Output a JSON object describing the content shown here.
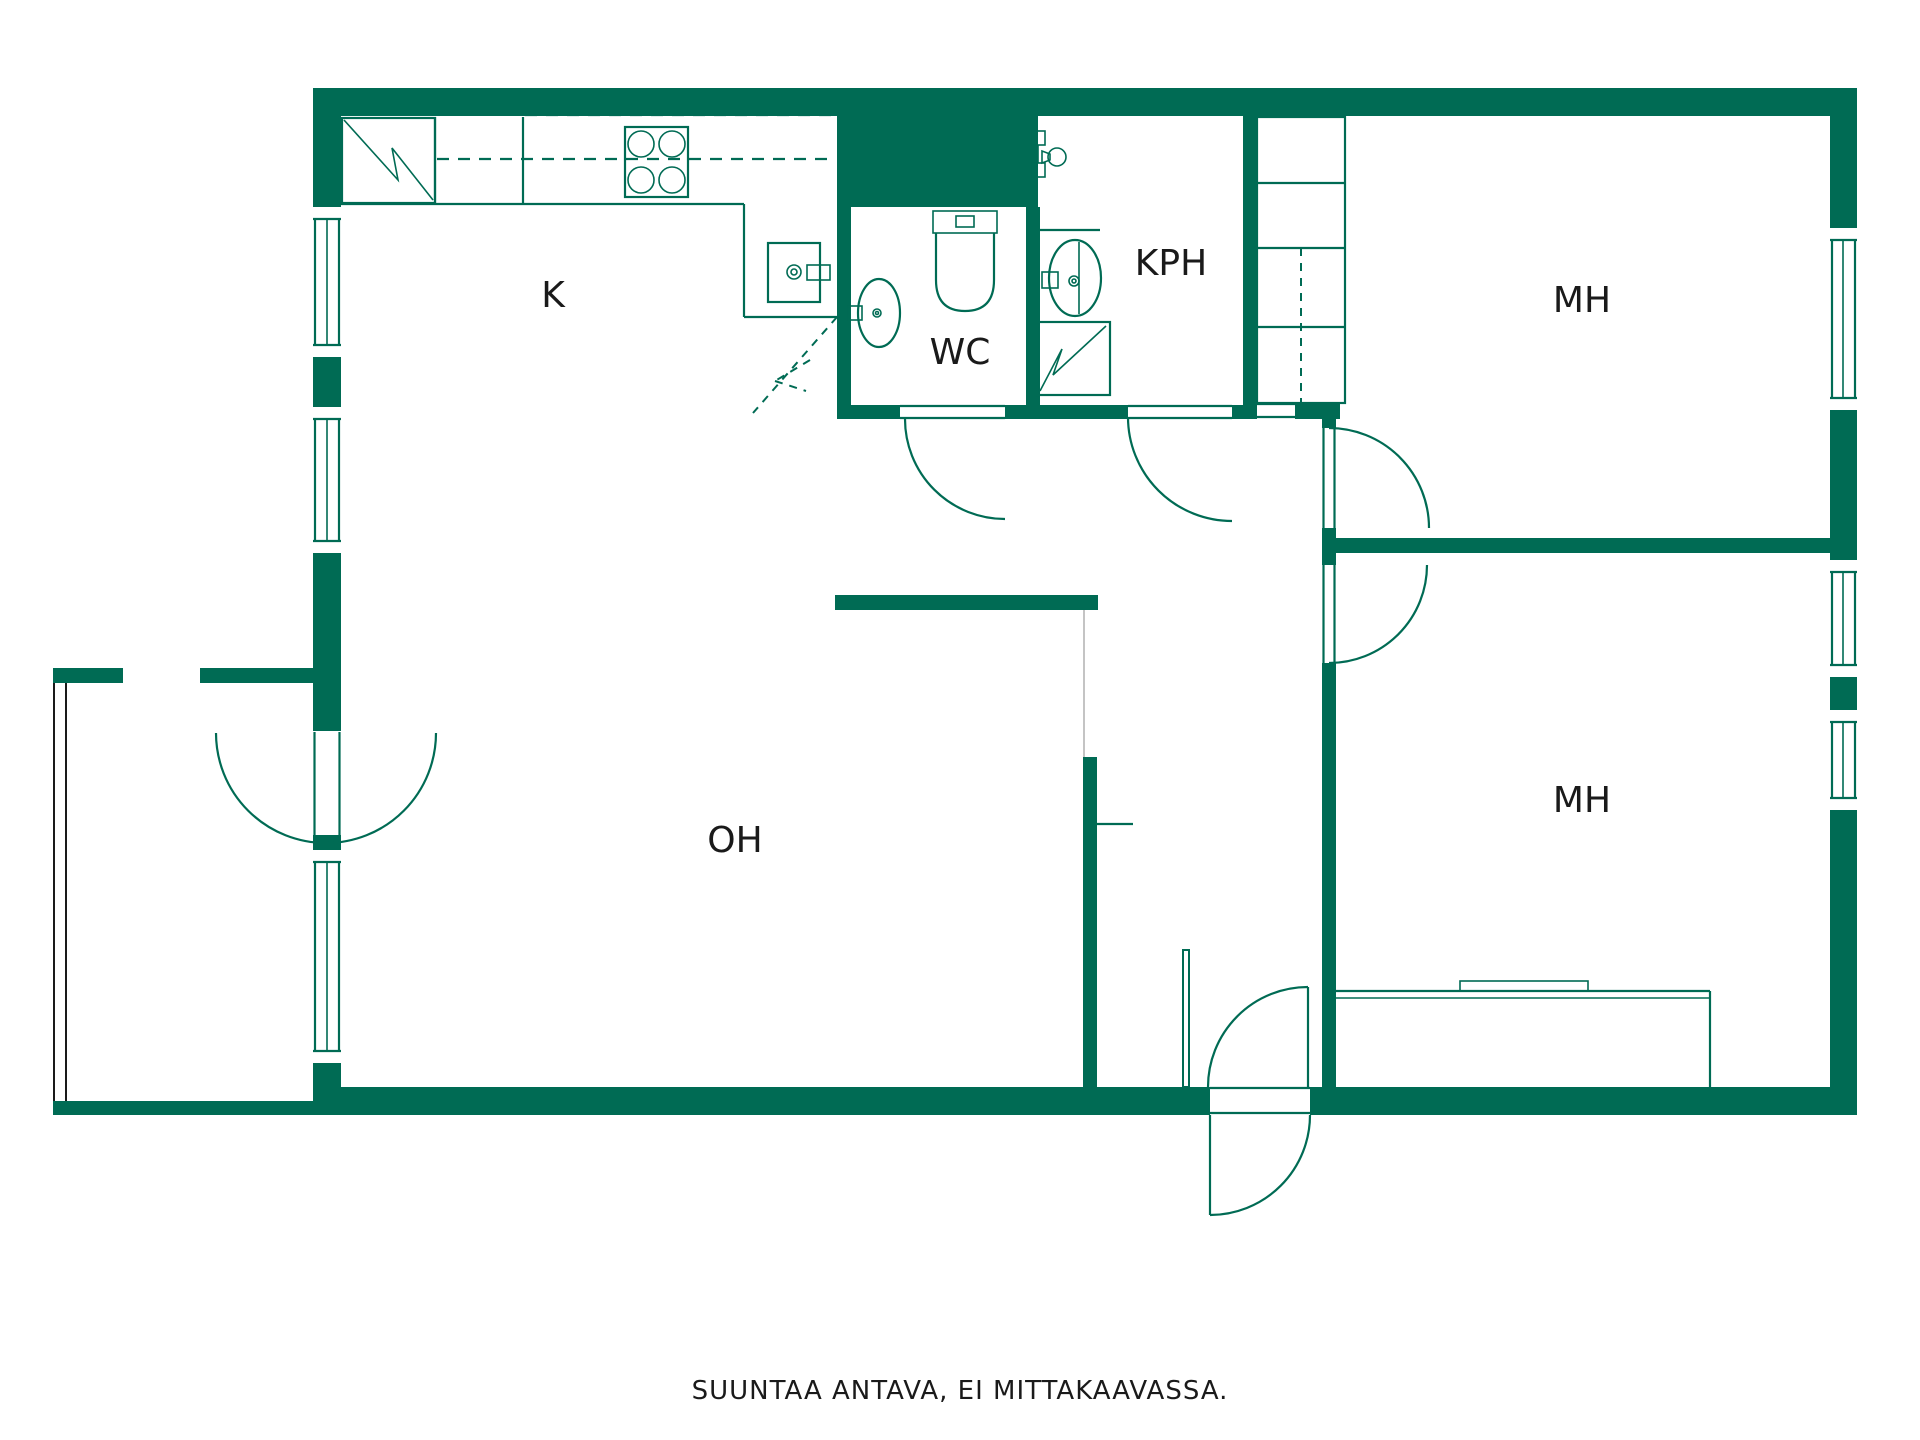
{
  "floorplan": {
    "rooms": [
      {
        "id": "kitchen",
        "label": "K"
      },
      {
        "id": "wc",
        "label": "WC"
      },
      {
        "id": "bathroom",
        "label": "KPH"
      },
      {
        "id": "bedroom-1",
        "label": "MH"
      },
      {
        "id": "bedroom-2",
        "label": "MH"
      },
      {
        "id": "living-room",
        "label": "OH"
      }
    ],
    "footnote": "SUUNTAA ANTAVA, EI MITTAKAAVASSA.",
    "colors": {
      "wall": "#006B54",
      "balcony_line": "#1a1a1a",
      "text": "#1a1a1a",
      "background": "#ffffff",
      "faint_line": "#c4c4c4"
    }
  }
}
